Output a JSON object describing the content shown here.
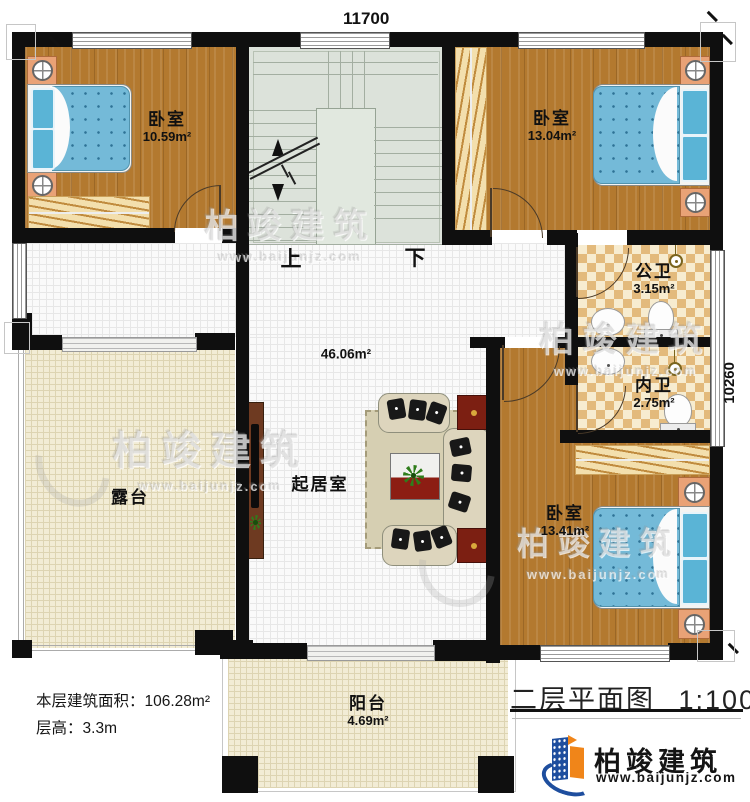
{
  "dimensions": {
    "top": "11700",
    "right": "10260"
  },
  "stairs": {
    "up": "上",
    "down": "下"
  },
  "rooms": {
    "bedroom1": {
      "name": "卧室",
      "area": "10.59m²"
    },
    "bedroom2": {
      "name": "卧室",
      "area": "13.04m²"
    },
    "public_bath": {
      "name": "公卫",
      "area": "3.15m²"
    },
    "inner_bath": {
      "name": "内卫",
      "area": "2.75m²"
    },
    "bedroom3": {
      "name": "卧室",
      "area": "13.41m²"
    },
    "living_room": {
      "name": "起居室",
      "area": "46.06m²"
    },
    "terrace": {
      "name": "露台"
    },
    "balcony": {
      "name": "阳台",
      "area": "4.69m²"
    }
  },
  "info": {
    "floor_area_label": "本层建筑面积：",
    "floor_area_value": "106.28m²",
    "floor_height_label": "层高：",
    "floor_height_value": "3.3m"
  },
  "title": {
    "plan_name": "二层平面图",
    "scale": "1:100"
  },
  "brand": {
    "name": "柏竣建筑",
    "url": "www.baijunjz.com"
  },
  "watermark": {
    "name": "柏竣建筑",
    "url": "www.baijunjz.com"
  },
  "colors": {
    "wall": "#0f0f0f",
    "wood_floor": "#b3792f",
    "bath_tile": "#e3ba7c",
    "mattress_blue": "#74bad8",
    "stair_green": "#dce2da",
    "terrace_cream": "#f2ecd5",
    "accent_red": "#8c1d13",
    "brand_blue": "#1e4e9e",
    "brand_orange": "#f08519"
  }
}
